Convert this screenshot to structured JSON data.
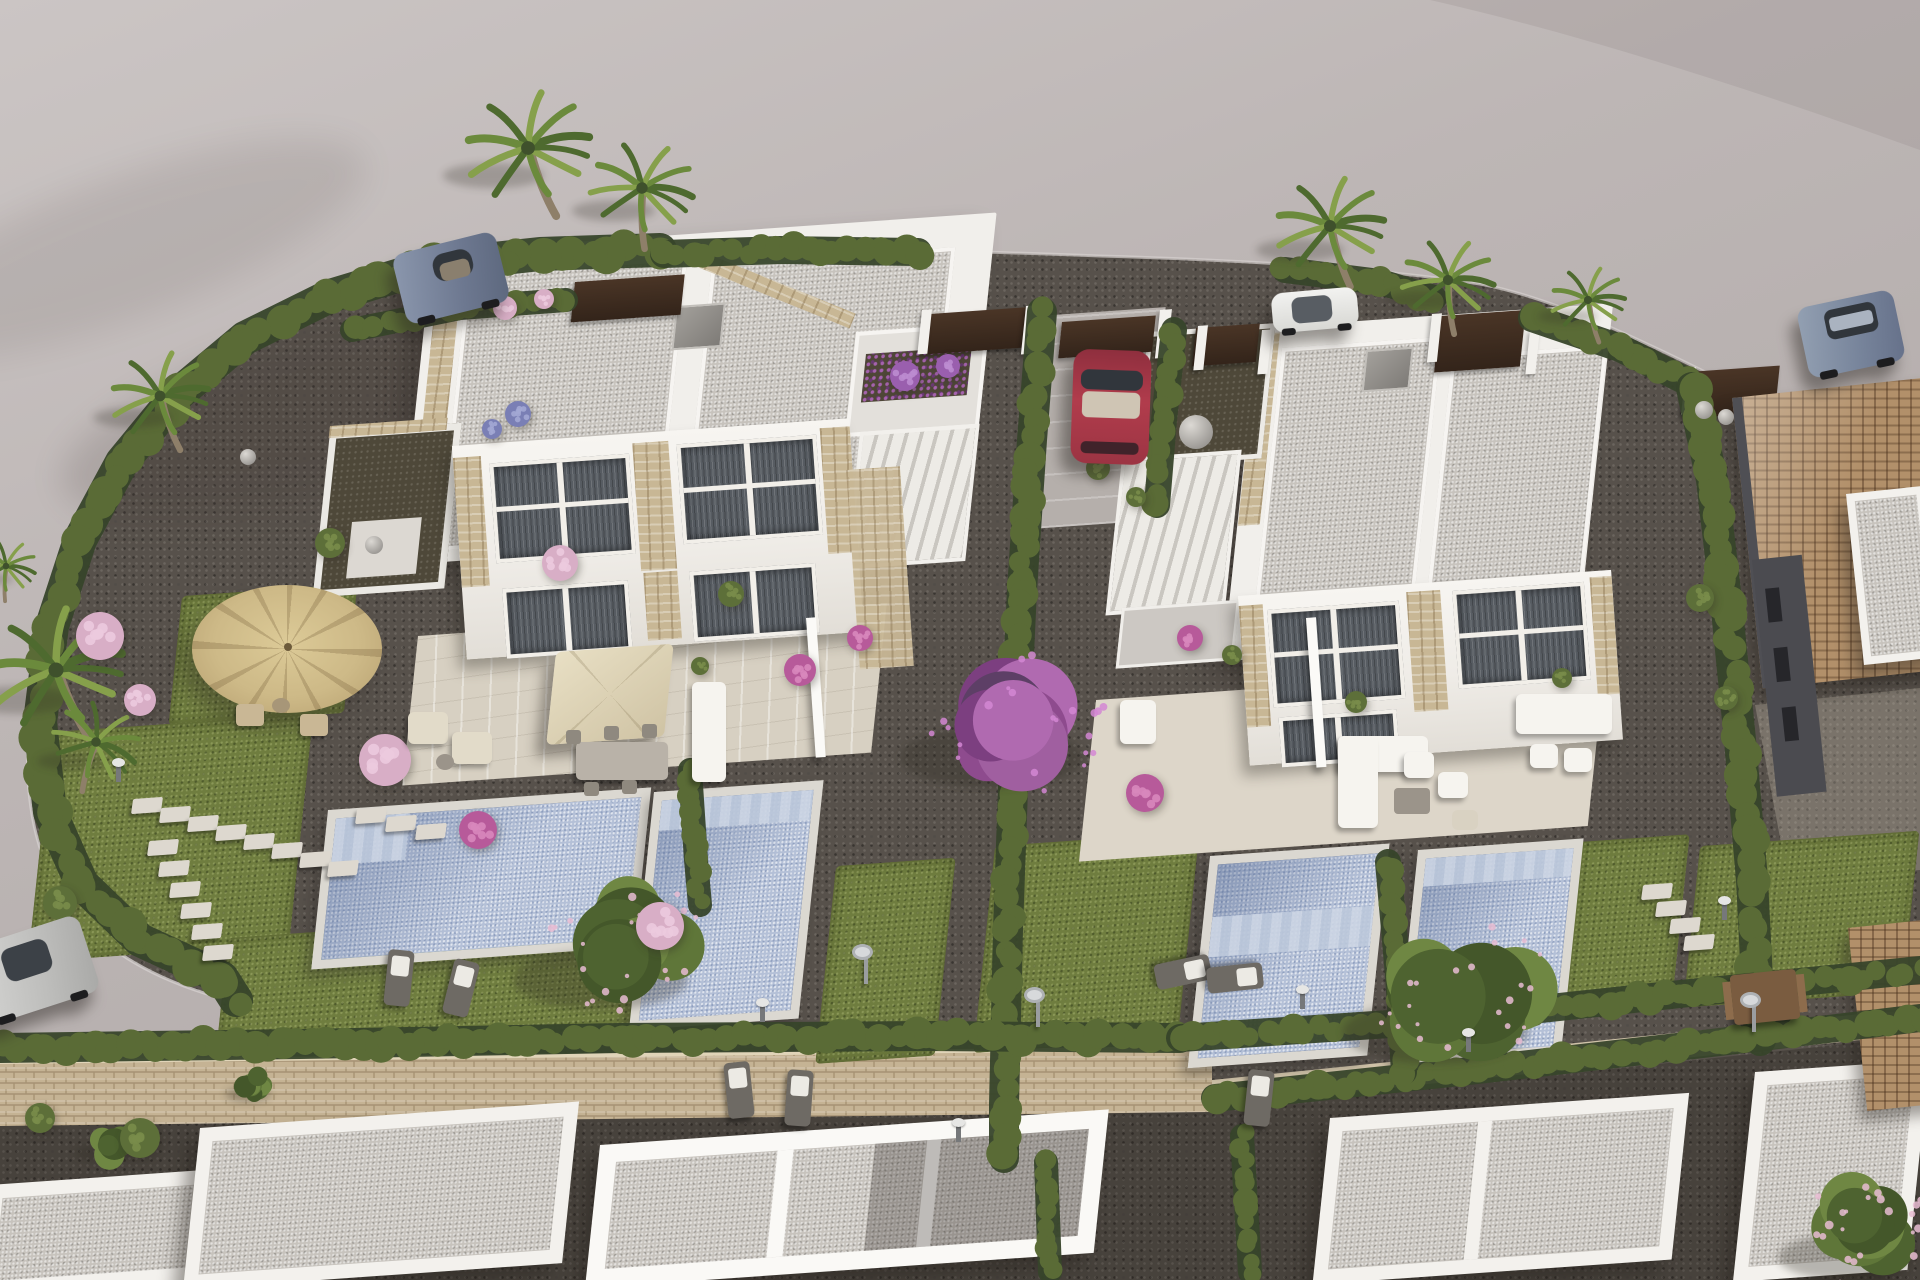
{
  "meta": {
    "description": "Aerial 3D architectural rendering of a new residential development: two modern white duplex villas with flat gravel roofs, rooftop terraces and exterior stairs, four private swimming pools, landscaped gravel gardens with lawns, cypress hedges, palm trees, a purple bougainvillea tree, parasols and garden furniture, five parked cars on the surrounding road, a neighbouring house with a terracotta tiled roof, a long sandstone boundary wall and further white flat roofs in the foreground."
  },
  "palette": {
    "road": "#bcb5b4",
    "road_light": "#cfc9c8",
    "road_shadow": "#9b9392",
    "gravel": "#57514b",
    "gravel_dark": "#47423c",
    "lawn": "#6f7d3f",
    "lawn_light": "#87914d",
    "hedge_dark": "#3e4e2a",
    "hedge_mid": "#5a6b36",
    "hedge_light": "#71823f",
    "roof_gravel": "#c7c3bd",
    "white_wall": "#f1efeb",
    "stone": "#c8b795",
    "terrace": "#d7d0c2",
    "pool_water": "#b4c0d7",
    "pool_coping": "#dbd8d1",
    "window_dark": "#575c62",
    "terracotta": "#b2906a",
    "fence_brown": "#3c2b1e",
    "car_red": "#a83848",
    "car_sports_blue": "#76829a",
    "car_white": "#e9e9e7",
    "car_silver": "#c4c4c2",
    "car_suv_blue": "#8390a3",
    "flower_pink": "#d8aec6",
    "flower_magenta": "#b75a9a",
    "flower_purple": "#9a5fae",
    "bougainvillea": "#a4549c",
    "umbrella_straw": "#cfbe8e",
    "umbrella_cream": "#ded3b6"
  },
  "scene": {
    "hedgeTones": [
      "#3e4e2a",
      "#5a6b36",
      "#71823f"
    ],
    "hedges": [
      {
        "name": "left-curve",
        "w": 30,
        "pts": [
          [
            660,
            250
          ],
          [
            540,
            254
          ],
          [
            430,
            266
          ],
          [
            330,
            296
          ],
          [
            245,
            338
          ],
          [
            178,
            394
          ],
          [
            122,
            462
          ],
          [
            80,
            540
          ],
          [
            52,
            626
          ],
          [
            40,
            722
          ],
          [
            50,
            812
          ],
          [
            82,
            884
          ],
          [
            140,
            940
          ],
          [
            222,
            978
          ],
          [
            236,
            1000
          ]
        ]
      },
      {
        "name": "top-a",
        "w": 24,
        "pts": [
          [
            664,
            254
          ],
          [
            780,
            250
          ],
          [
            918,
            252
          ]
        ]
      },
      {
        "name": "top-b",
        "w": 22,
        "pts": [
          [
            1285,
            270
          ],
          [
            1380,
            282
          ],
          [
            1434,
            298
          ]
        ]
      },
      {
        "name": "top-c",
        "w": 24,
        "pts": [
          [
            1532,
            318
          ],
          [
            1620,
            348
          ],
          [
            1688,
            382
          ]
        ]
      },
      {
        "name": "right-boundary",
        "w": 28,
        "pts": [
          [
            1692,
            388
          ],
          [
            1712,
            480
          ],
          [
            1726,
            600
          ],
          [
            1740,
            740
          ],
          [
            1752,
            880
          ],
          [
            1758,
            1000
          ],
          [
            1760,
            1040
          ]
        ]
      },
      {
        "name": "mid-long",
        "w": 26,
        "pts": [
          [
            1042,
            312
          ],
          [
            1032,
            440
          ],
          [
            1022,
            590
          ],
          [
            1014,
            760
          ],
          [
            1008,
            930
          ],
          [
            1004,
            1105
          ],
          [
            1004,
            1158
          ]
        ]
      },
      {
        "name": "drive-right",
        "w": 22,
        "pts": [
          [
            1174,
            330
          ],
          [
            1164,
            420
          ],
          [
            1157,
            505
          ]
        ]
      },
      {
        "name": "terrace-right",
        "w": 20,
        "pts": [
          [
            690,
            770
          ],
          [
            696,
            860
          ],
          [
            700,
            905
          ]
        ]
      },
      {
        "name": "wall-top",
        "w": 26,
        "pts": [
          [
            0,
            1048
          ],
          [
            300,
            1044
          ],
          [
            620,
            1038
          ],
          [
            930,
            1036
          ],
          [
            1180,
            1038
          ]
        ]
      },
      {
        "name": "bottom-right-upper",
        "w": 24,
        "pts": [
          [
            1180,
            1038
          ],
          [
            1420,
            1022
          ],
          [
            1680,
            994
          ],
          [
            1920,
            970
          ]
        ]
      },
      {
        "name": "bottom-right-lower",
        "w": 24,
        "pts": [
          [
            1215,
            1098
          ],
          [
            1460,
            1072
          ],
          [
            1720,
            1042
          ],
          [
            1920,
            1018
          ]
        ]
      },
      {
        "name": "between-pools",
        "w": 22,
        "pts": [
          [
            1388,
            862
          ],
          [
            1398,
            975
          ],
          [
            1404,
            1072
          ]
        ]
      },
      {
        "name": "bottom-strip-1",
        "w": 20,
        "pts": [
          [
            1046,
            1162
          ],
          [
            1050,
            1272
          ]
        ]
      },
      {
        "name": "bottom-strip-2",
        "w": 20,
        "pts": [
          [
            1242,
            1136
          ],
          [
            1250,
            1272
          ]
        ]
      },
      {
        "name": "villa1-back",
        "w": 20,
        "pts": [
          [
            352,
            330
          ],
          [
            460,
            308
          ],
          [
            566,
            300
          ]
        ]
      }
    ],
    "palms": [
      {
        "x": 528,
        "y": 148,
        "s": 1.15,
        "r": -8
      },
      {
        "x": 642,
        "y": 188,
        "s": 0.95,
        "r": 12
      },
      {
        "x": 1330,
        "y": 226,
        "s": 1.0,
        "r": -4
      },
      {
        "x": 1448,
        "y": 280,
        "s": 0.85,
        "r": 8
      },
      {
        "x": 1588,
        "y": 300,
        "s": 0.68,
        "r": 0
      },
      {
        "x": 160,
        "y": 396,
        "s": 0.9,
        "r": -6
      },
      {
        "x": 56,
        "y": 670,
        "s": 1.25,
        "r": -12
      },
      {
        "x": 6,
        "y": 566,
        "s": 0.55,
        "r": 16
      },
      {
        "x": 96,
        "y": 742,
        "s": 0.8,
        "r": 30
      }
    ],
    "trees": [
      {
        "x": 628,
        "y": 948,
        "r": 92,
        "kind": "green-pink"
      },
      {
        "x": 1020,
        "y": 724,
        "r": 96,
        "kind": "purple"
      },
      {
        "x": 1465,
        "y": 998,
        "r": 98,
        "kind": "green-pink"
      },
      {
        "x": 115,
        "y": 1142,
        "r": 32,
        "kind": "green"
      },
      {
        "x": 1868,
        "y": 1232,
        "r": 72,
        "kind": "green-pink"
      },
      {
        "x": 255,
        "y": 1086,
        "r": 24,
        "kind": "green"
      }
    ],
    "bushes": [
      [
        100,
        636,
        24,
        "pink"
      ],
      [
        140,
        700,
        16,
        "pink"
      ],
      [
        242,
        608,
        14,
        "pink"
      ],
      [
        385,
        760,
        26,
        "pink"
      ],
      [
        478,
        830,
        19,
        "magenta"
      ],
      [
        660,
        926,
        24,
        "pink"
      ],
      [
        560,
        563,
        18,
        "pink"
      ],
      [
        800,
        670,
        16,
        "magenta"
      ],
      [
        860,
        638,
        13,
        "magenta"
      ],
      [
        505,
        308,
        12,
        "pink"
      ],
      [
        544,
        299,
        10,
        "pink"
      ],
      [
        905,
        376,
        15,
        "purple"
      ],
      [
        948,
        366,
        12,
        "purple"
      ],
      [
        518,
        414,
        13,
        "blue"
      ],
      [
        492,
        429,
        10,
        "blue"
      ],
      [
        1145,
        793,
        19,
        "magenta"
      ],
      [
        1190,
        638,
        13,
        "magenta"
      ],
      [
        60,
        903,
        17,
        "green"
      ],
      [
        330,
        543,
        15,
        "green"
      ],
      [
        731,
        594,
        13,
        "green"
      ],
      [
        1098,
        468,
        12,
        "green"
      ],
      [
        1136,
        497,
        10,
        "green"
      ],
      [
        1700,
        598,
        14,
        "green"
      ],
      [
        1726,
        698,
        12,
        "green"
      ],
      [
        140,
        1138,
        20,
        "green"
      ],
      [
        40,
        1118,
        15,
        "green"
      ],
      [
        1232,
        655,
        10,
        "green"
      ],
      [
        1356,
        702,
        11,
        "green"
      ],
      [
        1562,
        678,
        10,
        "green"
      ],
      [
        700,
        666,
        9,
        "green"
      ]
    ],
    "stones": [
      {
        "x": 132,
        "y": 798,
        "n": 8,
        "dx": 28,
        "dy": 9
      },
      {
        "x": 148,
        "y": 840,
        "n": 6,
        "dx": 11,
        "dy": 21
      },
      {
        "x": 356,
        "y": 808,
        "n": 3,
        "dx": 30,
        "dy": 8
      },
      {
        "x": 1642,
        "y": 884,
        "n": 4,
        "dx": 14,
        "dy": 17
      }
    ],
    "spheres": [
      [
        1196,
        432,
        17
      ],
      [
        1704,
        410,
        9
      ],
      [
        1726,
        417,
        8
      ],
      [
        374,
        545,
        9
      ],
      [
        248,
        457,
        8
      ]
    ],
    "lamps": [
      [
        116,
        766
      ],
      [
        760,
        1006
      ],
      [
        956,
        1126
      ],
      [
        1300,
        993
      ],
      [
        1466,
        1036
      ],
      [
        1722,
        904
      ]
    ],
    "showers": [
      [
        864,
        950
      ],
      [
        1036,
        993
      ],
      [
        1752,
        998
      ]
    ],
    "loungers": [
      {
        "x": 386,
        "y": 950,
        "rot": 6
      },
      {
        "x": 448,
        "y": 960,
        "rot": 14
      },
      {
        "x": 726,
        "y": 1062,
        "rot": -6
      },
      {
        "x": 786,
        "y": 1070,
        "rot": 4
      },
      {
        "x": 1246,
        "y": 1070,
        "rot": 6
      },
      {
        "x": 1170,
        "y": 944,
        "rot": 78
      },
      {
        "x": 1222,
        "y": 950,
        "rot": 84
      }
    ]
  }
}
